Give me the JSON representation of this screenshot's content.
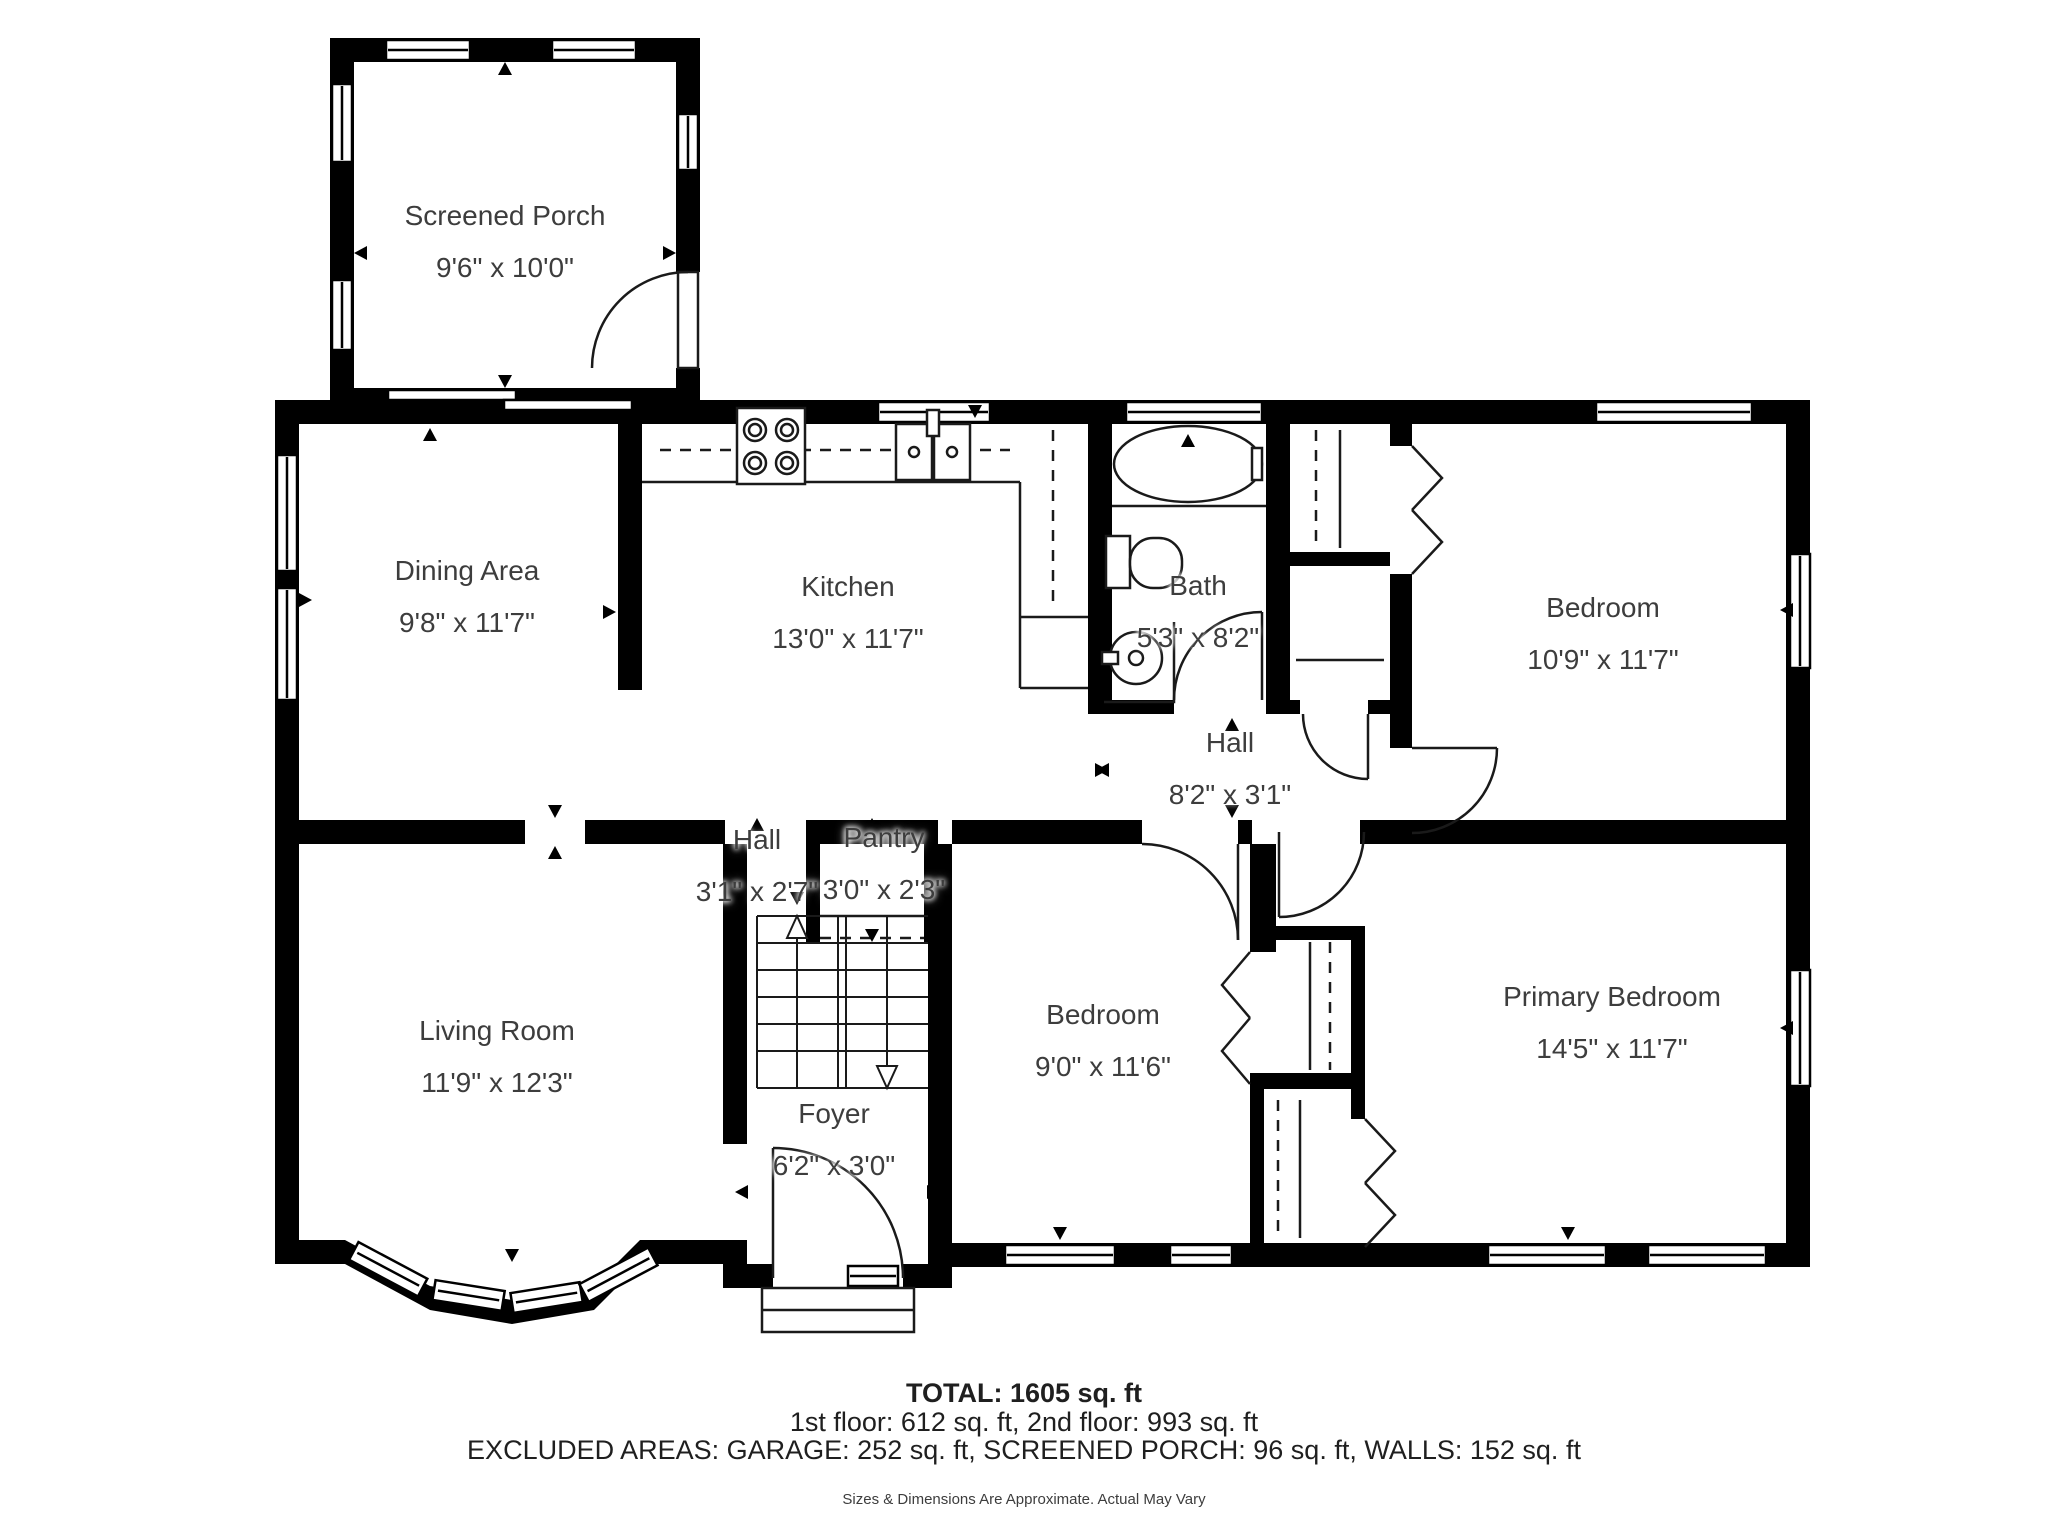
{
  "rooms": [
    {
      "id": "screened-porch",
      "name": "Screened Porch",
      "dims": "9'6\" x 10'0\""
    },
    {
      "id": "dining-area",
      "name": "Dining Area",
      "dims": "9'8\" x 11'7\""
    },
    {
      "id": "kitchen",
      "name": "Kitchen",
      "dims": "13'0\" x 11'7\""
    },
    {
      "id": "bath",
      "name": "Bath",
      "dims": "5'3\" x 8'2\""
    },
    {
      "id": "bedroom-upper",
      "name": "Bedroom",
      "dims": "10'9\" x 11'7\""
    },
    {
      "id": "hall-upper",
      "name": "Hall",
      "dims": "8'2\" x 3'1\""
    },
    {
      "id": "hall-stairs",
      "name": "Hall",
      "dims": "3'1\" x 2'7\""
    },
    {
      "id": "pantry",
      "name": "Pantry",
      "dims": "3'0\" x 2'3\""
    },
    {
      "id": "living-room",
      "name": "Living Room",
      "dims": "11'9\" x 12'3\""
    },
    {
      "id": "bedroom-lower",
      "name": "Bedroom",
      "dims": "9'0\" x 11'6\""
    },
    {
      "id": "primary-bedroom",
      "name": "Primary Bedroom",
      "dims": "14'5\" x 11'7\""
    },
    {
      "id": "foyer",
      "name": "Foyer",
      "dims": "6'2\" x 3'0\""
    }
  ],
  "summary": {
    "total": "TOTAL: 1605 sq. ft",
    "floors": "1st floor: 612 sq. ft, 2nd floor: 993 sq. ft",
    "excluded": "EXCLUDED AREAS: GARAGE: 252 sq. ft, SCREENED PORCH: 96 sq. ft, WALLS: 152 sq. ft",
    "disclaimer": "Sizes & Dimensions Are Approximate. Actual May Vary"
  },
  "colors": {
    "wall": "#000000",
    "line": "#1a1a1a",
    "label_text": "#3d3d3d"
  }
}
